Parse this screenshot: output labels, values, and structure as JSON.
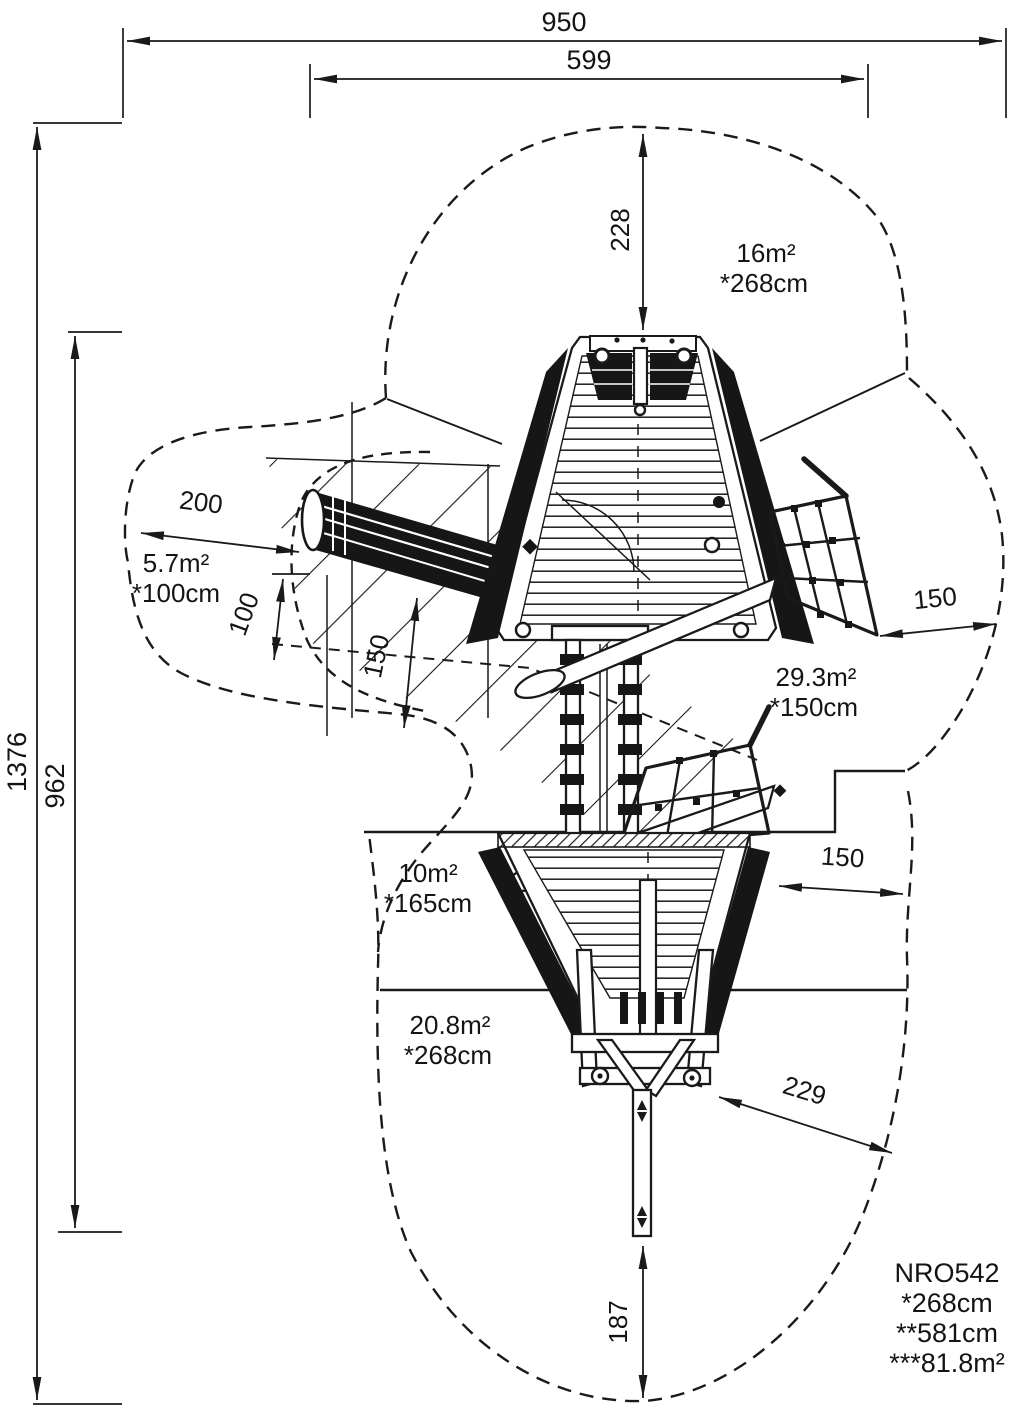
{
  "dimensions": {
    "overall_width": "950",
    "structure_width": "599",
    "overall_depth": "1376",
    "structure_depth": "962",
    "top_clearance": "228",
    "tube_zone_length": "200",
    "tube_zone_width": "100",
    "tube_side_clearance": "150",
    "upper_right_clearance": "150",
    "lower_right_clearance": "150",
    "stern_clearance": "229",
    "bottom_clearance": "187"
  },
  "zones": {
    "top": {
      "area": "16m²",
      "fall_height": "*268cm"
    },
    "left": {
      "area": "5.7m²",
      "fall_height": "*100cm"
    },
    "right": {
      "area": "29.3m²",
      "fall_height": "*150cm"
    },
    "middle": {
      "area": "10m²",
      "fall_height": "*165cm"
    },
    "bottom": {
      "area": "20.8m²",
      "fall_height": "*268cm"
    }
  },
  "product": {
    "code": "NRO542",
    "spec_height": "*268cm",
    "spec_length": "**581cm",
    "spec_area": "***81.8m²"
  }
}
